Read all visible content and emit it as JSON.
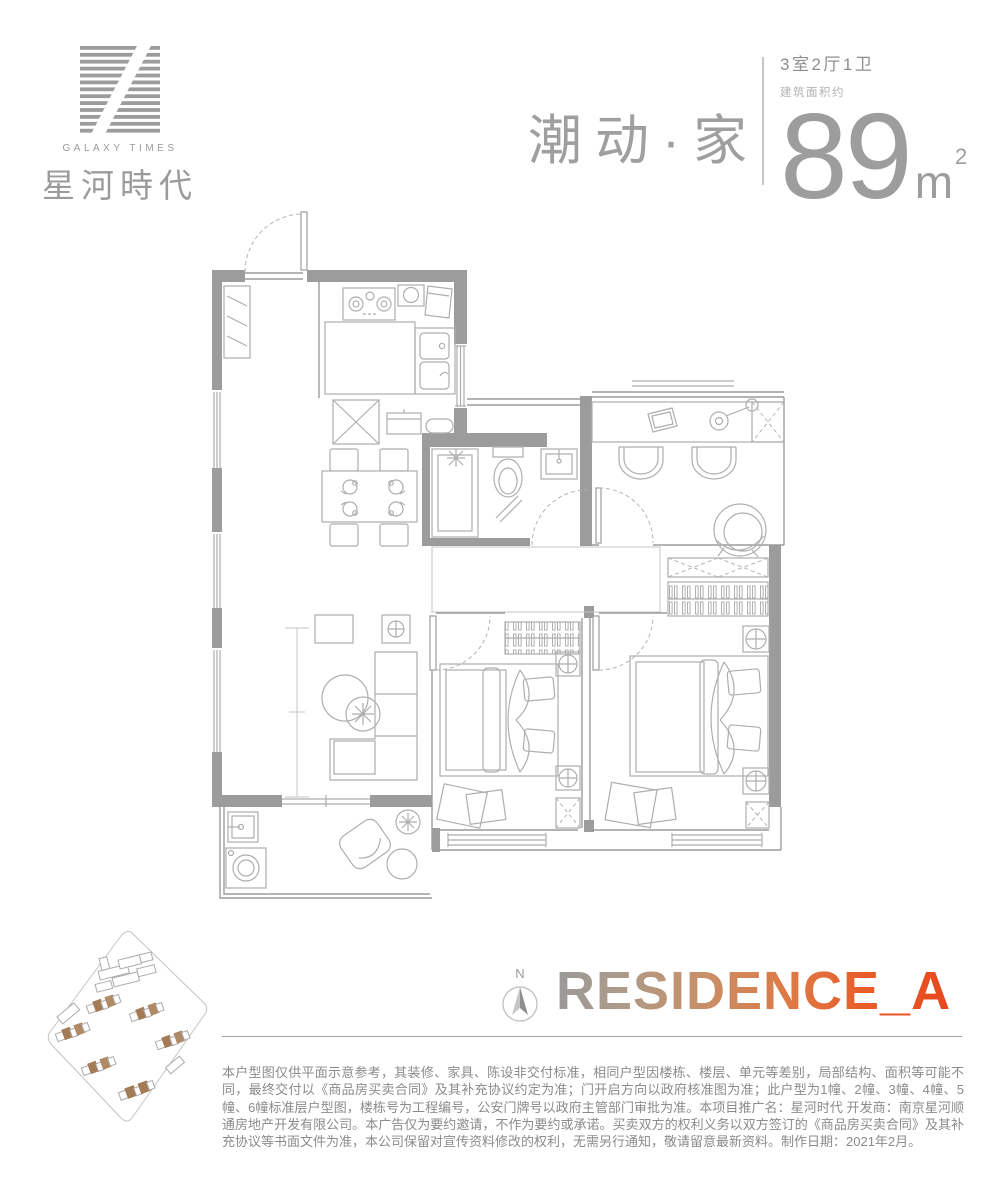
{
  "logo": {
    "en": "GALAXY TIMES",
    "cn": "星河時代"
  },
  "header": {
    "slogan": "潮动·家",
    "spec": "3室2厅1卫",
    "area_label": "建筑面积约",
    "area_number": "89",
    "area_unit": "m",
    "area_exp": "2"
  },
  "residence": {
    "compass_n": "N",
    "title": "RESIDENCE_A"
  },
  "disclaimer": {
    "text": "本户型图仅供平面示意参考，其装修、家具、陈设非交付标准，相同户型因楼栋、楼层、单元等差别，局部结构、面积等可能不同，最终交付以《商品房买卖合同》及其补充协议约定为准；门开启方向以政府核准图为准；此户型为1幢、2幢、3幢、4幢、5幢、6幢标准层户型图，楼栋号为工程编号，公安门牌号以政府主管部门审批为准。本项目推广名：星河时代 开发商：南京星河顺通房地产开发有限公司。本广告仅为要约邀请，不作为要约或承诺。买卖双方的权利义务以双方签订的《商品房买卖合同》及其补充协议等书面文件为准，本公司保留对宣传资料修改的权利，无需另行通知，敬请留意最新资料。制作日期：2021年2月。"
  },
  "floorplan": {
    "icons": [
      "entry-door",
      "shoe-cabinet",
      "stove",
      "kitchen-sink",
      "fridge",
      "kitchen-island",
      "dining-table",
      "dining-chairs",
      "shower",
      "toilet",
      "vanity-sink",
      "desk",
      "laptop",
      "desk-lamp",
      "desk-chairs",
      "lounge-chair",
      "storage-box",
      "wardrobe",
      "double-bed",
      "nightstand-lamp",
      "rug",
      "tv-stand",
      "floor-lamp",
      "sofa",
      "coffee-table",
      "plant",
      "laundry-sink",
      "washing-machine",
      "balcony-chair",
      "side-table",
      "window",
      "door-swing"
    ]
  },
  "colors": {
    "wall_gray": "#9c9c9c",
    "furniture_line": "#aeaeae",
    "brand_gray": "#9b9b9b",
    "title_gray": "#9d9d9d",
    "text_gray": "#8b8b8b",
    "site_brown": "#a57b55",
    "residence_gradient": [
      "#9a9a98",
      "#ae9a88",
      "#c98f66",
      "#e07642",
      "#e85a28",
      "#e7491f"
    ]
  }
}
